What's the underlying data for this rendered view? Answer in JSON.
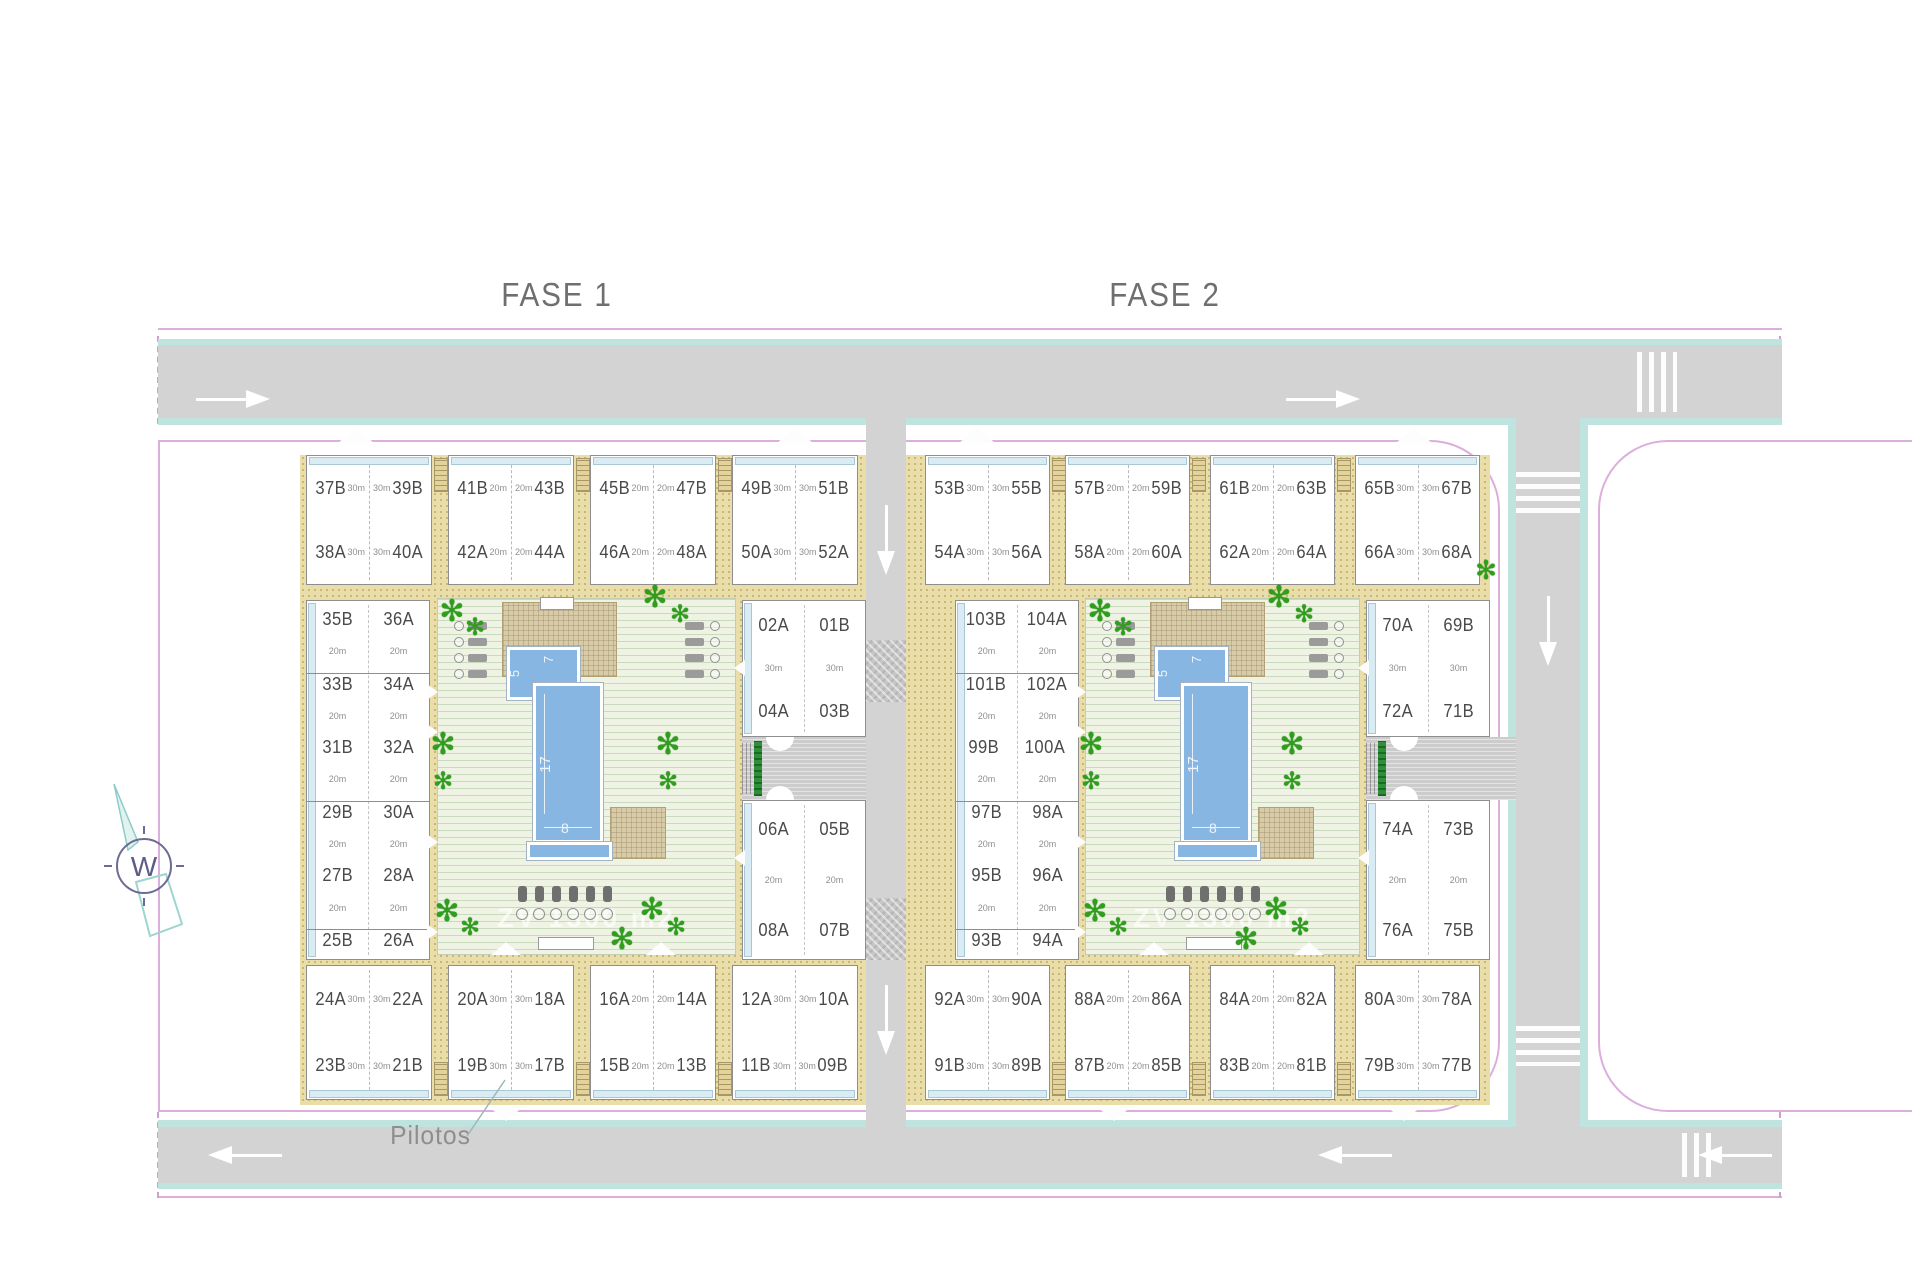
{
  "titles": {
    "fase1": "FASE 1",
    "fase2": "FASE 2"
  },
  "annotations": {
    "pilotos": "Pilotos",
    "compass_letter": "W",
    "courtyard_watermark": "ZV 1300 m2"
  },
  "pool_dims": {
    "length": "17",
    "width": "8",
    "small_side": "5",
    "small_top": "7"
  },
  "area_labels": {
    "small": "20m",
    "large": "30m"
  },
  "fase1": {
    "top_row": [
      {
        "r1": [
          "37B",
          "39B"
        ],
        "r2": [
          "38A",
          "40A"
        ],
        "area": "30m"
      },
      {
        "r1": [
          "41B",
          "43B"
        ],
        "r2": [
          "42A",
          "44A"
        ],
        "area": "20m"
      },
      {
        "r1": [
          "45B",
          "47B"
        ],
        "r2": [
          "46A",
          "48A"
        ],
        "area": "20m"
      },
      {
        "r1": [
          "49B",
          "51B"
        ],
        "r2": [
          "50A",
          "52A"
        ],
        "area": "30m"
      }
    ],
    "left_col": {
      "pairs": [
        [
          "35B",
          "36A"
        ],
        [
          "33B",
          "34A"
        ],
        [
          "31B",
          "32A"
        ],
        [
          "29B",
          "30A"
        ],
        [
          "27B",
          "28A"
        ],
        [
          "25B",
          "26A"
        ]
      ],
      "area": "20m"
    },
    "inner_top": {
      "pairs": [
        [
          "02A",
          "01B"
        ],
        [
          "04A",
          "03B"
        ]
      ],
      "area": "30m"
    },
    "inner_bottom": {
      "pairs": [
        [
          "06A",
          "05B"
        ],
        [
          "08A",
          "07B"
        ]
      ],
      "area": "20m"
    },
    "bottom_row": [
      {
        "r1": [
          "24A",
          "22A"
        ],
        "r2": [
          "23B",
          "21B"
        ],
        "area": "30m"
      },
      {
        "r1": [
          "20A",
          "18A"
        ],
        "r2": [
          "19B",
          "17B"
        ],
        "area": "30m"
      },
      {
        "r1": [
          "16A",
          "14A"
        ],
        "r2": [
          "15B",
          "13B"
        ],
        "area": "20m"
      },
      {
        "r1": [
          "12A",
          "10A"
        ],
        "r2": [
          "11B",
          "09B"
        ],
        "area": "30m"
      }
    ]
  },
  "fase2": {
    "top_row": [
      {
        "r1": [
          "53B",
          "55B"
        ],
        "r2": [
          "54A",
          "56A"
        ],
        "area": "30m"
      },
      {
        "r1": [
          "57B",
          "59B"
        ],
        "r2": [
          "58A",
          "60A"
        ],
        "area": "20m"
      },
      {
        "r1": [
          "61B",
          "63B"
        ],
        "r2": [
          "62A",
          "64A"
        ],
        "area": "20m"
      },
      {
        "r1": [
          "65B",
          "67B"
        ],
        "r2": [
          "66A",
          "68A"
        ],
        "area": "30m"
      }
    ],
    "left_col": {
      "pairs": [
        [
          "103B",
          "104A"
        ],
        [
          "101B",
          "102A"
        ],
        [
          "99B",
          "100A"
        ],
        [
          "97B",
          "98A"
        ],
        [
          "95B",
          "96A"
        ],
        [
          "93B",
          "94A"
        ]
      ],
      "area": "20m"
    },
    "inner_top": {
      "pairs": [
        [
          "70A",
          "69B"
        ],
        [
          "72A",
          "71B"
        ]
      ],
      "area": "30m"
    },
    "inner_bottom": {
      "pairs": [
        [
          "74A",
          "73B"
        ],
        [
          "76A",
          "75B"
        ]
      ],
      "area": "20m"
    },
    "bottom_row": [
      {
        "r1": [
          "92A",
          "90A"
        ],
        "r2": [
          "91B",
          "89B"
        ],
        "area": "30m"
      },
      {
        "r1": [
          "88A",
          "86A"
        ],
        "r2": [
          "87B",
          "85B"
        ],
        "area": "20m"
      },
      {
        "r1": [
          "84A",
          "82A"
        ],
        "r2": [
          "83B",
          "81B"
        ],
        "area": "20m"
      },
      {
        "r1": [
          "80A",
          "78A"
        ],
        "r2": [
          "79B",
          "77B"
        ],
        "area": "30m"
      }
    ]
  },
  "colors": {
    "road": "#d3d3d3",
    "sidewalk_teal": "#bfe3df",
    "boundary_pink": "#dcaedc",
    "sand": "#e9dda9",
    "lawn": "#eef3e3",
    "pool_blue": "#87b6e3",
    "palm_green": "#2f9e1c",
    "label_text": "#4a4a4a"
  }
}
